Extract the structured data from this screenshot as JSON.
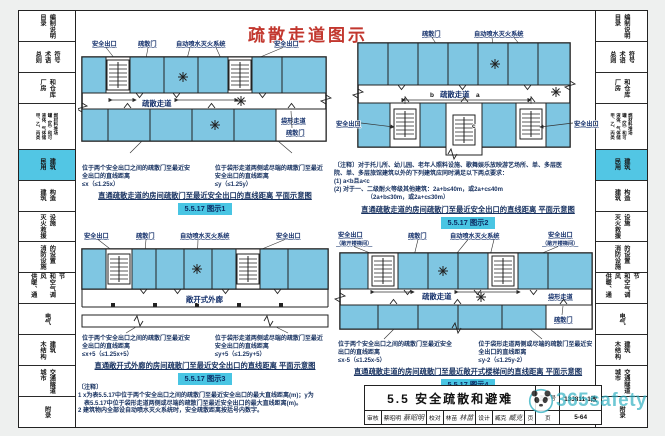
{
  "heading": "疏散走道图示",
  "labels": {
    "safe_exit": "安全出口",
    "evac_door": "疏散门",
    "sprinkler": "自动喷水灭火系统",
    "corridor": "疏散走道",
    "dead_end": "袋形走道",
    "open_gallery": "敞开式外廊",
    "open_stair_suffix": "（敞开楼梯间）",
    "marker_a": "a",
    "marker_b": "b",
    "marker_c": "c"
  },
  "sidebar": {
    "items": [
      {
        "label": "目录\n编制说明",
        "active": false
      },
      {
        "label": "总则\n术语\n符号",
        "active": false
      },
      {
        "label": "厂房\n和仓库",
        "active": false
      },
      {
        "label": "甲、乙、丙类\n液体、气体储\n罐（区）和可\n燃材料堆场",
        "active": false
      },
      {
        "label": "民用\n建筑",
        "active": true
      },
      {
        "label": "建筑\n构造",
        "active": false
      },
      {
        "label": "灭火救援\n设施",
        "active": false
      },
      {
        "label": "消防设施\n的设置",
        "active": false
      },
      {
        "label": "供暖、通风\n和空气调节",
        "active": false
      },
      {
        "label": "电气",
        "active": false
      },
      {
        "label": "木结构\n建筑",
        "active": false
      },
      {
        "label": "城市\n交通隧道",
        "active": false
      },
      {
        "label": "附录",
        "active": false
      }
    ]
  },
  "figures": [
    {
      "badge": "5.5.17 图示1",
      "caption": "直通疏散走道的房间疏散门至最近安全出口的直线距离 平面示意图",
      "callout_left": "位于两个安全出口之间的疏散门至最近安全出口的直线距离\n≤x（≤1.25x）",
      "callout_right": "位于袋形走道两侧或尽端的疏散门至最近安全出口的直线距离\n≤y（≤1.25y）"
    },
    {
      "badge": "5.5.17 图示2",
      "caption": "直通疏散走道的房间疏散门至最近安全出口的直线距离 平面示意图",
      "note": "〔注释〕对于托儿所、幼儿园、老年人照料设施、歌舞娱乐放映游艺场所、单、多层医\n院、单、多层旅馆建筑以外的下列建筑应同时满足以下两点要求：\n(1) a<b且a<c\n(2) 对于一、二级耐火等级其他建筑：2a+b≤40m，或2a+c≤40m\n　　　　　　（2a+b≤30m，或2a+c≤30m）"
    },
    {
      "badge": "5.5.17 图示3",
      "caption": "直通敞开式外廊的房间疏散门至最近安全出口的直线距离 平面示意图",
      "callout_left": "位于两个安全出口之间的疏散门至最近安全出口的直线距离\n≤x+5（≤1.25x+5）",
      "callout_right": "位于袋形走道两侧或尽端的疏散门至最近安全出口的直线距离\n≤y+5（≤1.25y+5）"
    },
    {
      "badge": "5.5.17 图示4",
      "caption": "直通疏散走道的房间疏散门至最近敞开式楼梯间的直线距离 平面示意图",
      "callout_left": "位于两个安全出口之间的疏散门至最近安全出口的直线距离\n≤x-5（≤1.25x-5）",
      "callout_right": "位于袋形走道两侧或尽端的疏散门至最近安全出口的直线距离\n≤y-2（≤1.25y-2）"
    }
  ],
  "notes_bottom": "〔注释〕\n1 x为表5.5.17中位于两个安全出口之间的疏散门至最近安全出口的最大直线距离(m)；y为\n　表5.5.17中位于袋形走道两侧或尽端的疏散门至最近安全出口的最大直线距离(m)。\n2 建筑物内全部设自动喷水灭火系统时，安全疏散距离按括号内数字。",
  "titleblock": {
    "section_title": "5.5 安全疏散和避难",
    "review_label": "审核",
    "review_name": "蔡昭明",
    "check_label": "校对",
    "check_name": "林苗",
    "design_label": "设计",
    "design_name": "臧克",
    "page_label": "页",
    "atlas_label": "图集号",
    "atlas_no": "13J811-1改",
    "page_no": "5-64"
  },
  "watermark": {
    "text": "365safety"
  }
}
